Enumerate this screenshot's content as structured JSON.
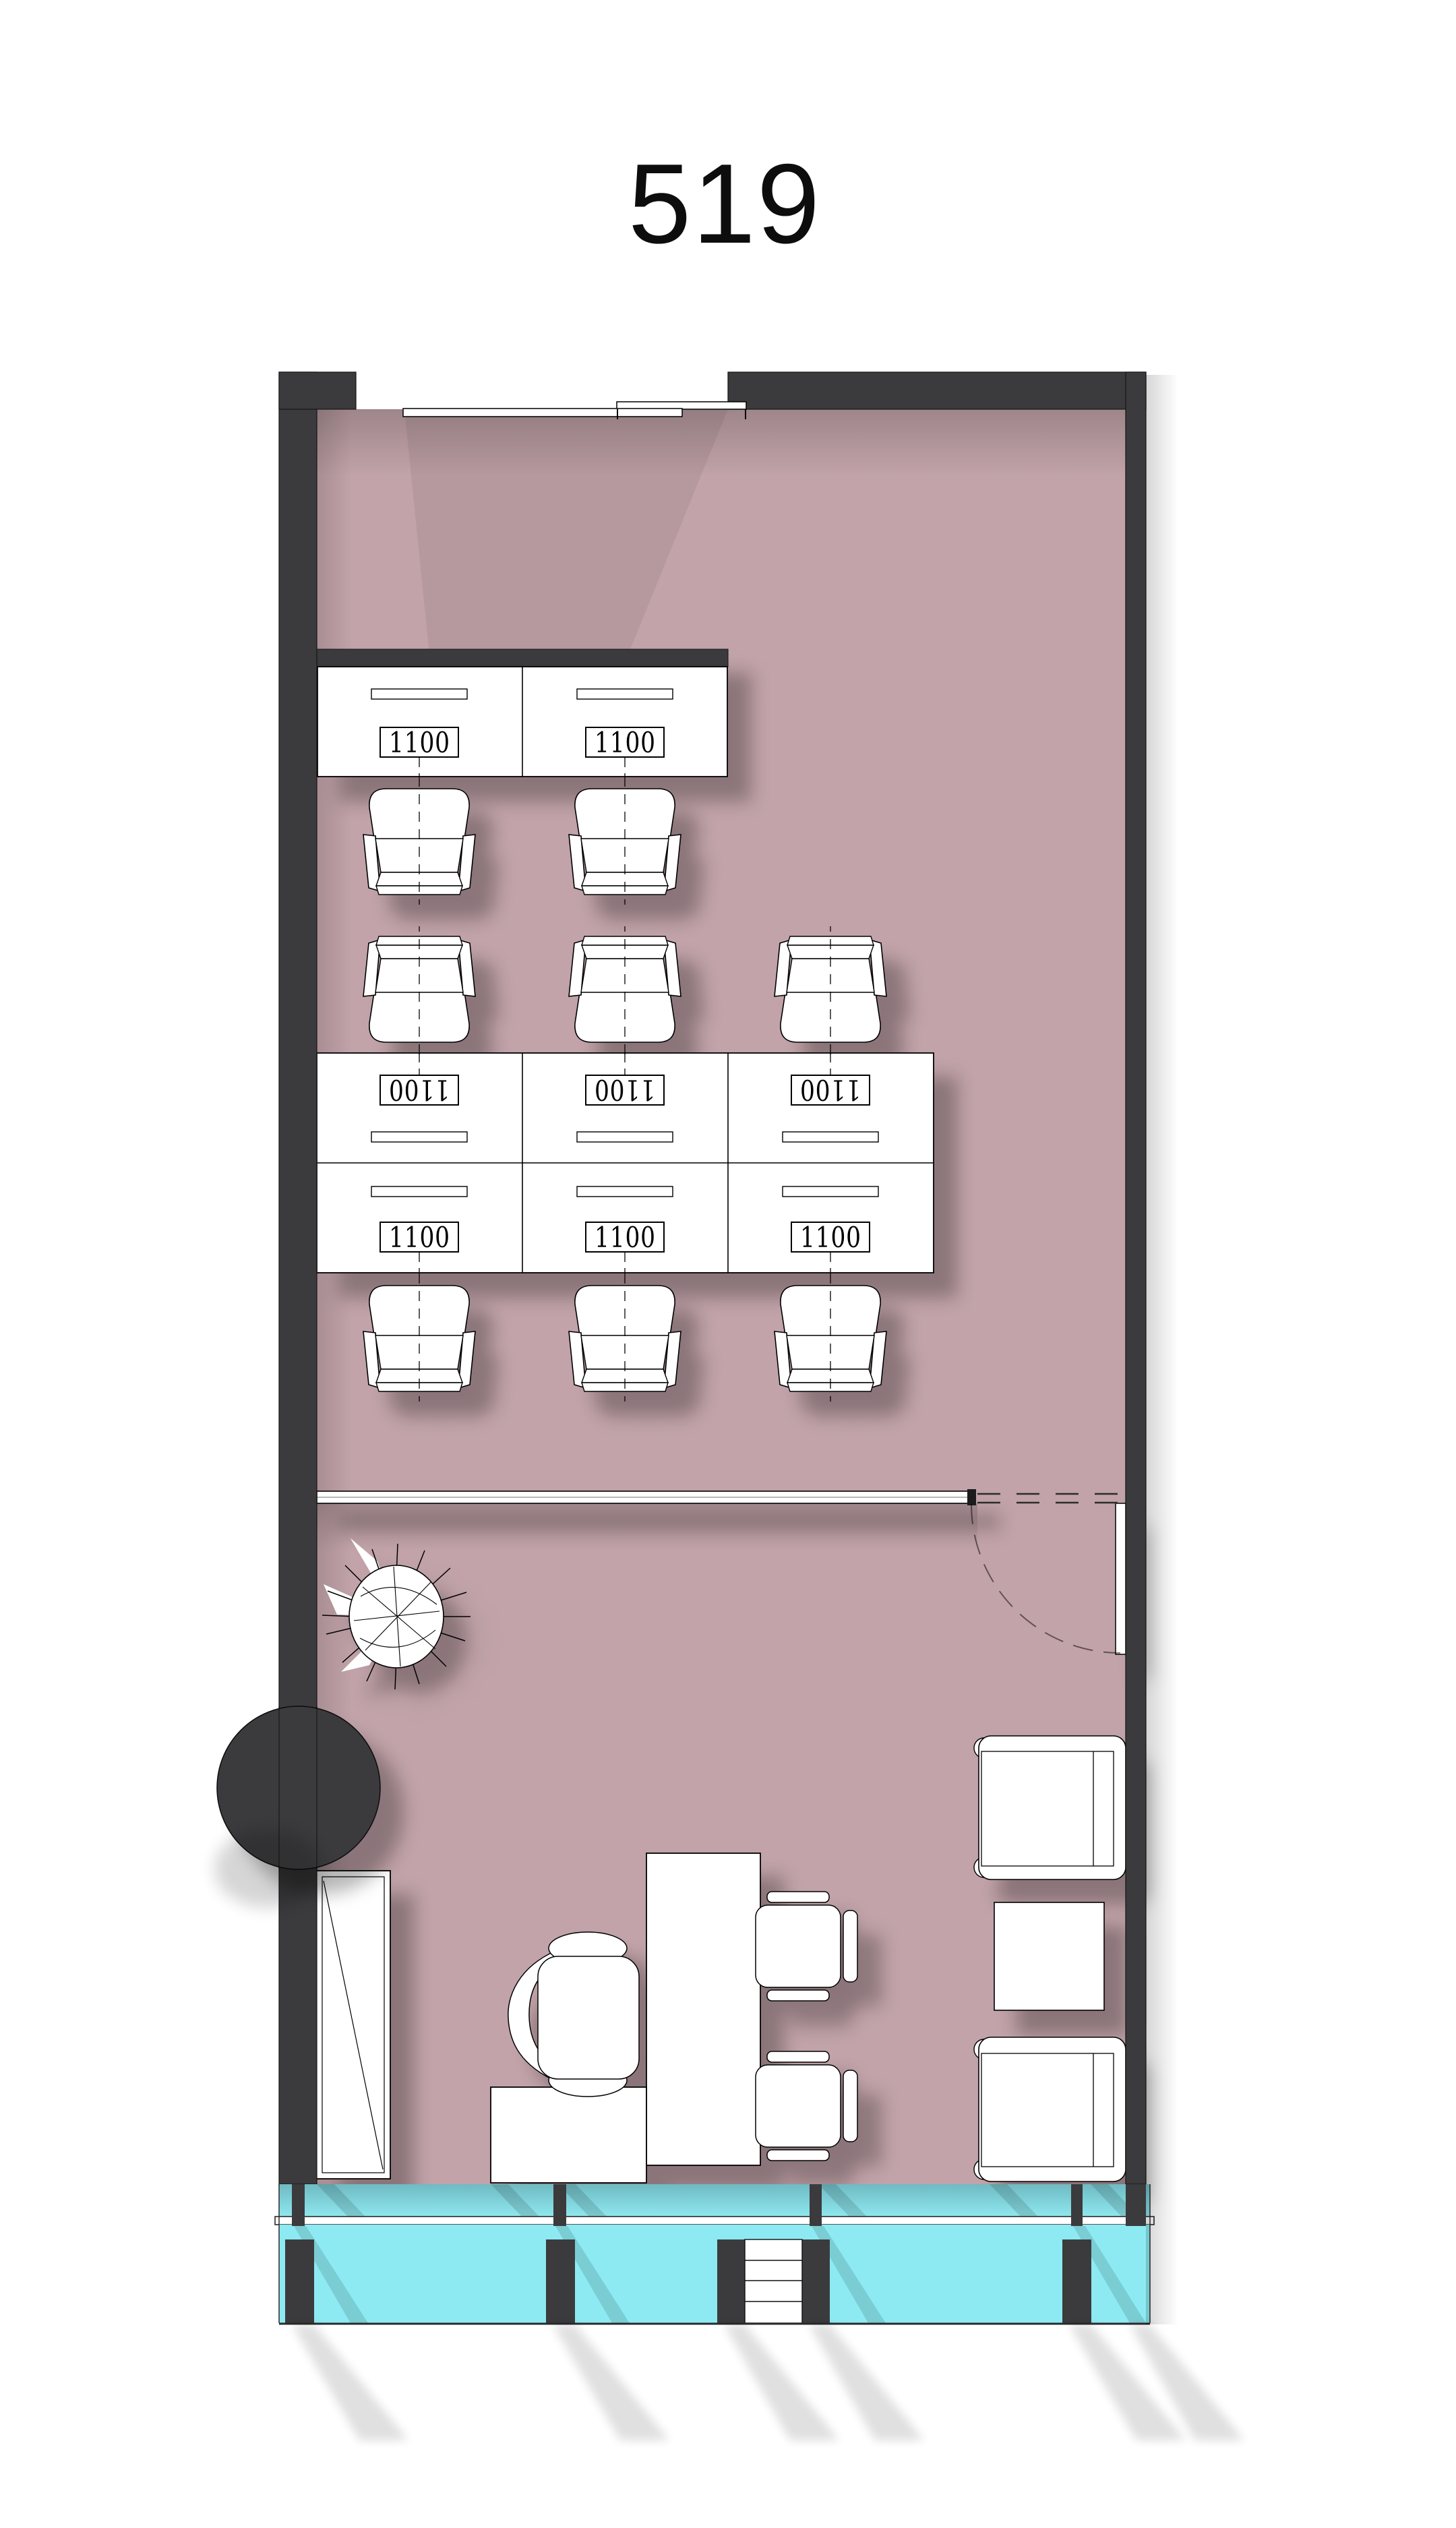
{
  "title": "519",
  "plan": {
    "desk_labels": [
      {
        "value": "1100"
      },
      {
        "value": "1100"
      },
      {
        "value": "1100"
      },
      {
        "value": "1100"
      },
      {
        "value": "1100"
      },
      {
        "value": "1100"
      },
      {
        "value": "1100"
      },
      {
        "value": "1100"
      }
    ]
  },
  "colors": {
    "floor": "#c1a3a9",
    "wall": "#3b3b3d",
    "glass_upper_top": "#6fbac3",
    "glass_upper_bottom": "#8fe7ee",
    "glass_lower": "#8deaf2",
    "furniture": "#ffffff",
    "line": "#000000",
    "title_text": "#0d0d0d"
  }
}
